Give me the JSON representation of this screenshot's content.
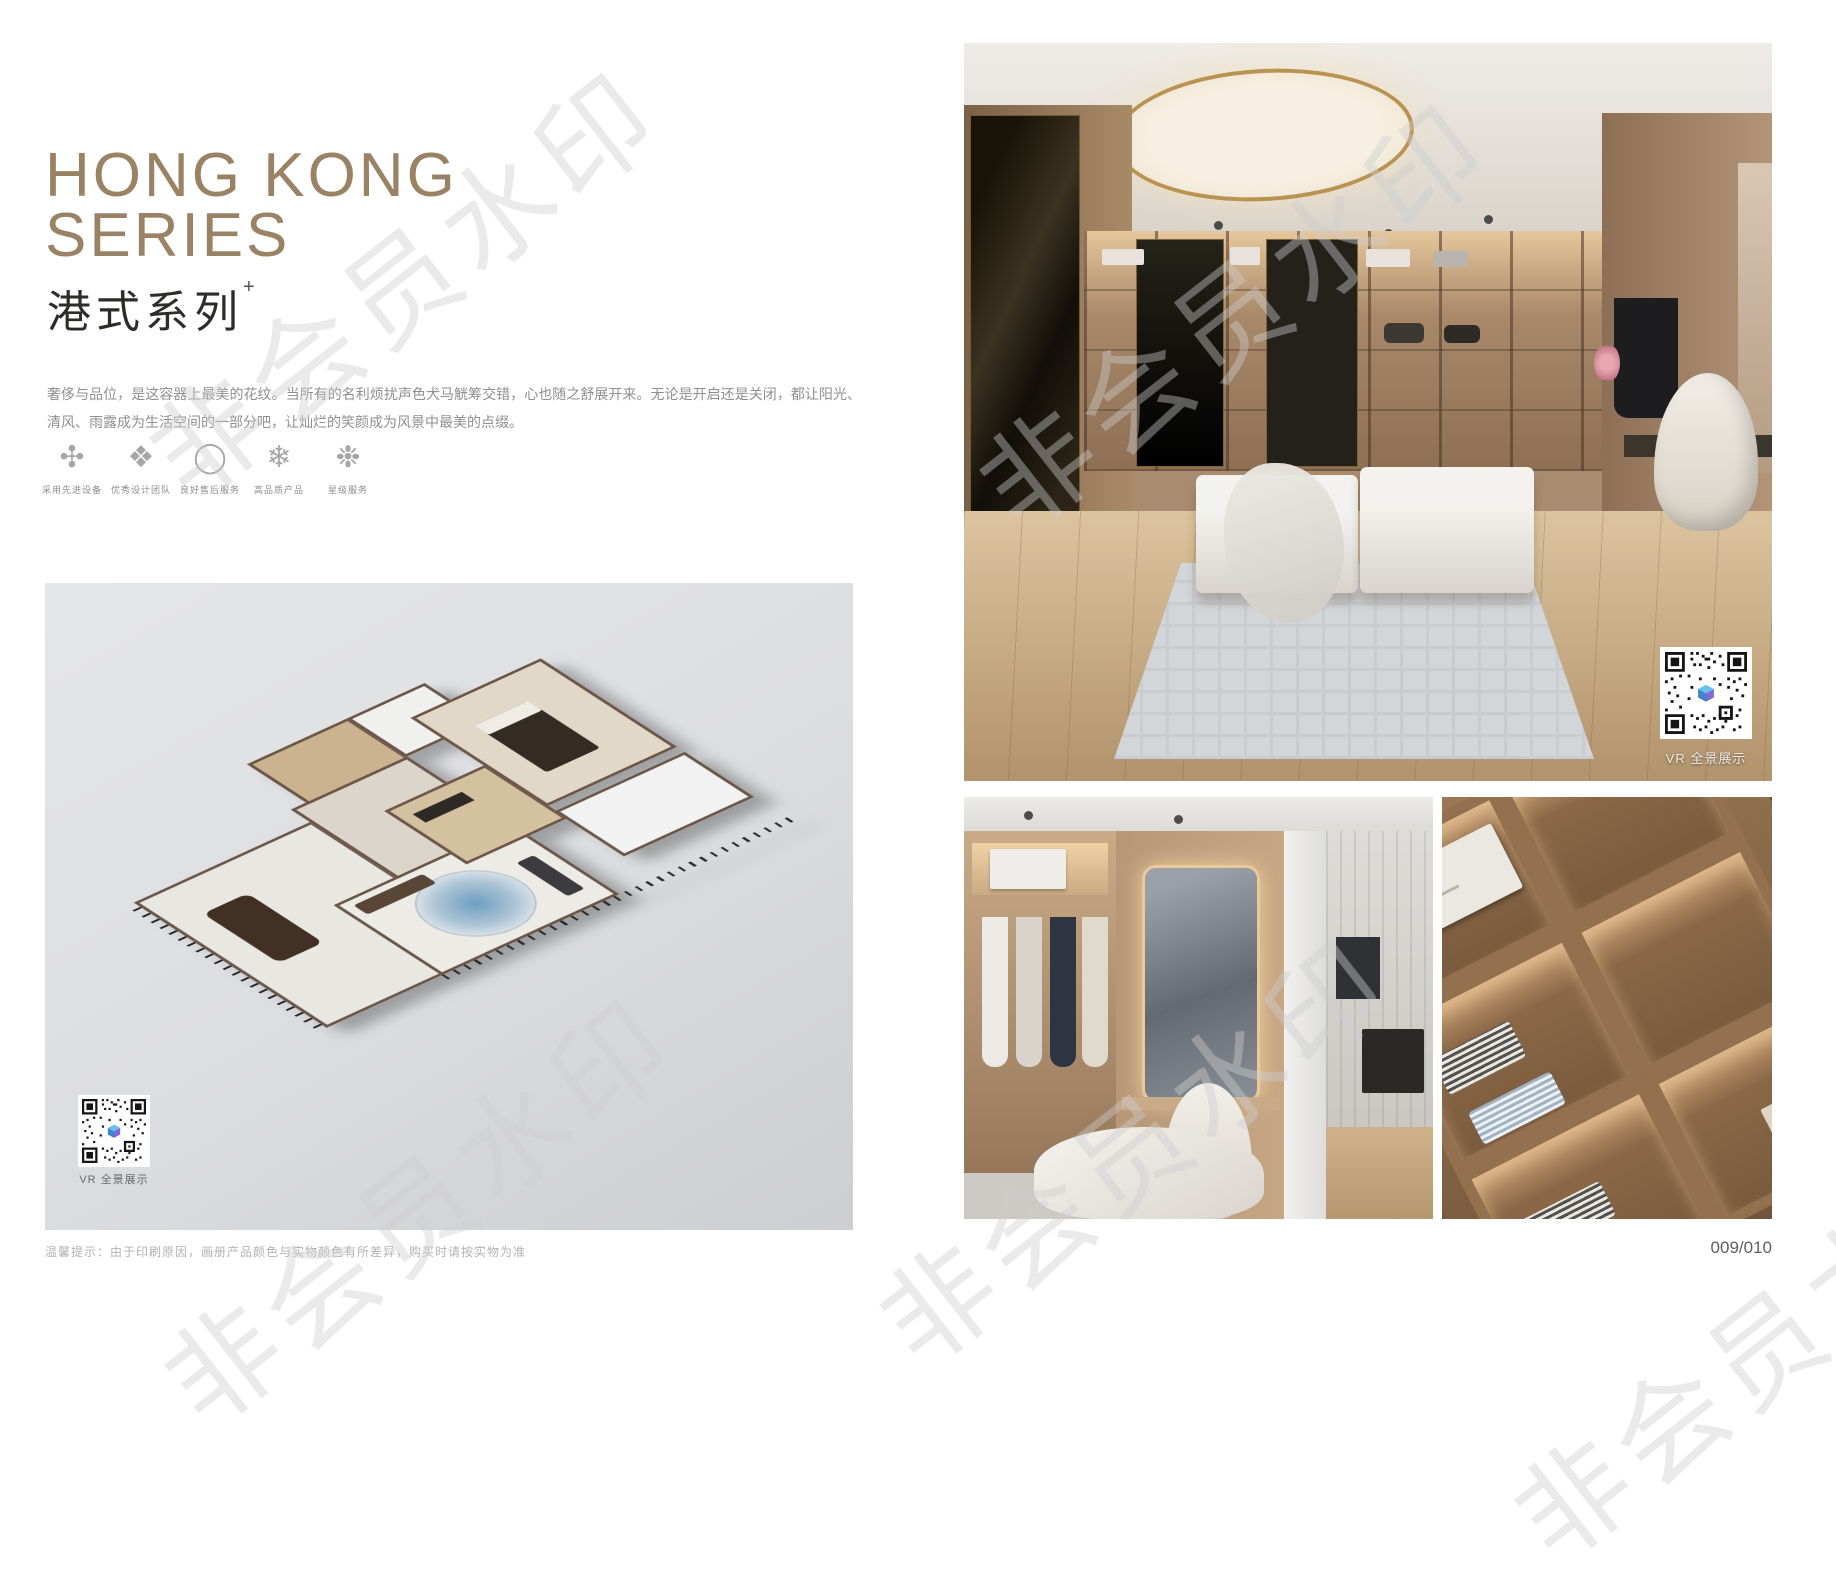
{
  "page": {
    "watermark_text": "非会员水印",
    "footer_note": "温馨提示：由于印刷原因，画册产品颜色与实物颜色有所差异，购买时请按实物为准",
    "page_number": "009/010"
  },
  "intro": {
    "title_line1": "HONG KONG",
    "title_line2": "SERIES",
    "subtitle": "港式系列",
    "subtitle_superscript": "+",
    "description": "奢侈与品位，是这容器上最美的花纹。当所有的名利烦扰声色犬马觥筹交错，心也随之舒展开来。无论是开启还是关闭，都让阳光、清风、雨露成为生活空间的一部分吧，让灿烂的笑颜成为风景中最美的点缀。"
  },
  "features": {
    "items": [
      {
        "icon": "advanced-equipment-icon",
        "glyph": "✣",
        "label": "采用先进设备"
      },
      {
        "icon": "design-team-icon",
        "glyph": "❖",
        "label": "优秀设计团队"
      },
      {
        "icon": "after-sales-service-icon",
        "glyph": "◯",
        "label": "良好售后服务"
      },
      {
        "icon": "high-quality-product-icon",
        "glyph": "❄",
        "label": "高品质产品"
      },
      {
        "icon": "star-service-icon",
        "glyph": "❉",
        "label": "星级服务"
      }
    ]
  },
  "floorplan": {
    "vr_label": "VR 全景展示"
  },
  "gallery": {
    "vr_label": "VR 全景展示"
  },
  "colors": {
    "title_bronze": "#9a8365",
    "accent_gold": "#b9934f",
    "panel_gray": "#dddee1"
  }
}
